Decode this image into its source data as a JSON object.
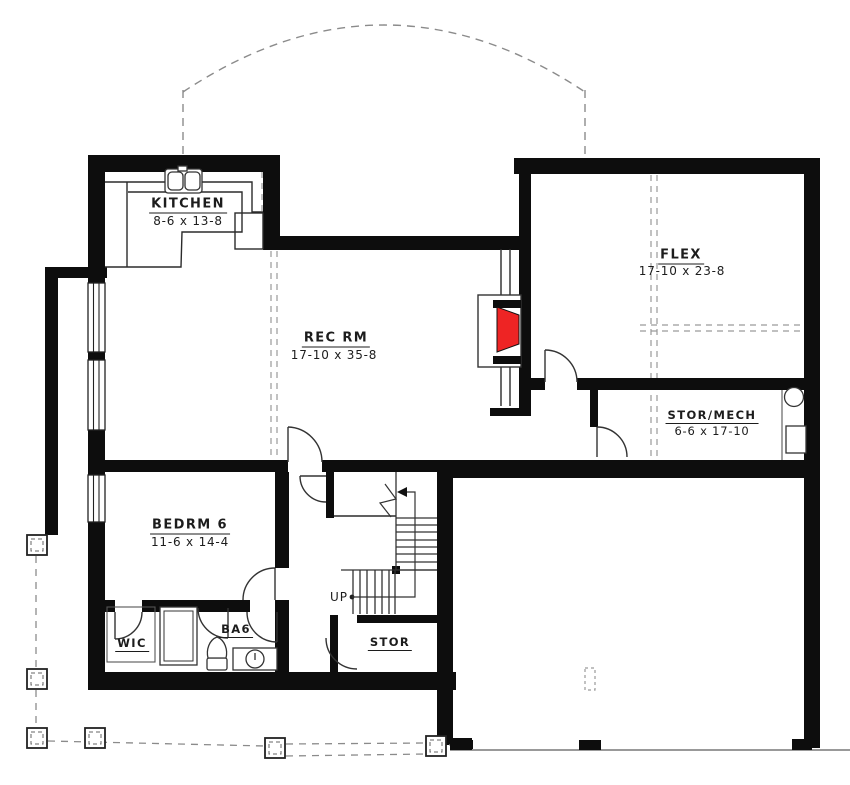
{
  "plan": {
    "type": "floor-plan",
    "level": "basement",
    "rooms": {
      "kitchen": {
        "name": "KITCHEN",
        "dims": "8-6 x 13-8"
      },
      "flex": {
        "name": "FLEX",
        "dims": "17-10 x 23-8"
      },
      "rec_rm": {
        "name": "REC RM",
        "dims": "17-10 x 35-8"
      },
      "stor_mech": {
        "name": "STOR/MECH",
        "dims": "6-6 x 17-10"
      },
      "bedrm6": {
        "name": "BEDRM 6",
        "dims": "11-6 x 14-4"
      },
      "wic": {
        "name": "WIC"
      },
      "ba6": {
        "name": "BA6"
      },
      "stor": {
        "name": "STOR"
      }
    },
    "annotations": {
      "stairs_up": "UP"
    },
    "colors": {
      "background": "#ffffff",
      "wall": "#0d0d0d",
      "fireplace_red": "#ee2424",
      "thin_line": "#2b2b2b",
      "dashed_line": "#8b8b8b"
    }
  }
}
